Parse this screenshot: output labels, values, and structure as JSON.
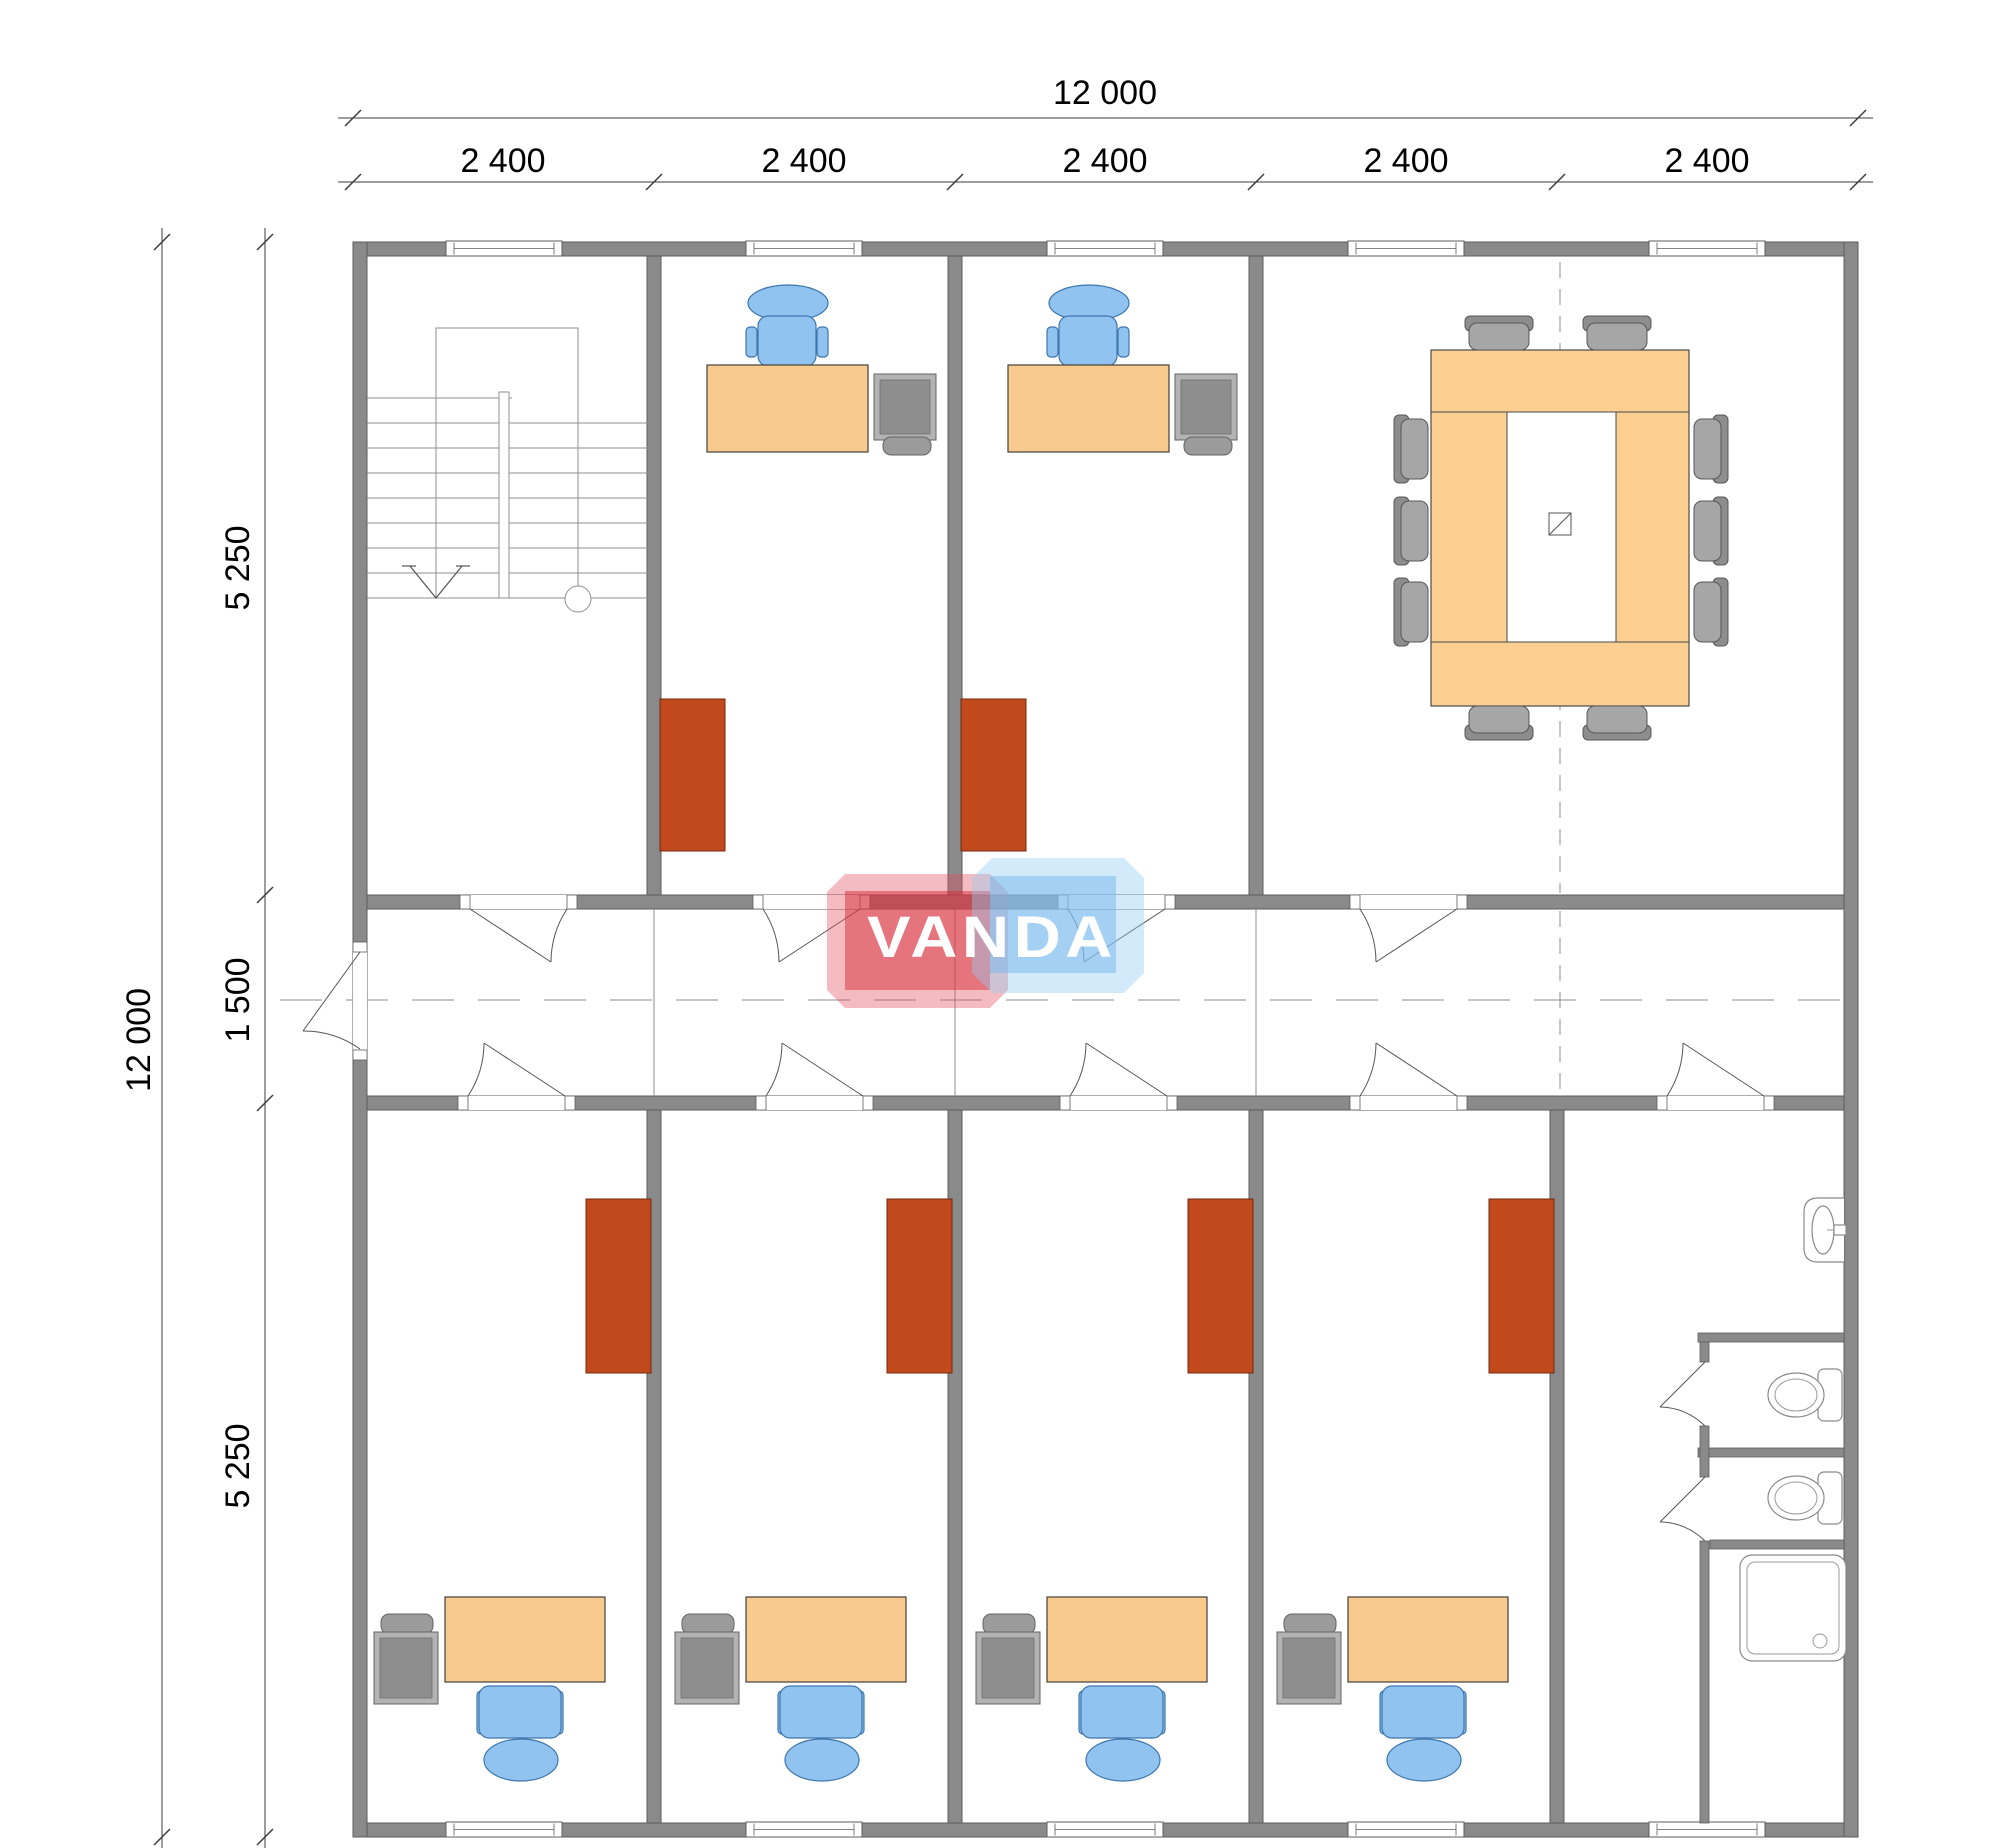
{
  "dimensions": {
    "top": {
      "total": "12 000",
      "segments": [
        "2 400",
        "2 400",
        "2 400",
        "2 400",
        "2 400"
      ]
    },
    "left": {
      "total": "12 000",
      "segments": [
        "5 250",
        "1 500",
        "5 250"
      ]
    }
  },
  "watermark": {
    "text": "VANDA",
    "red_color": "#d93a46",
    "blue_color": "#9fd0f0"
  },
  "palette": {
    "wall_gray": "#8a8a8a",
    "desk_tan": "#F8CA8E",
    "chair_blue": "#90C3EF",
    "cabinet_red": "#C2491C",
    "furniture_gray": "#9b9b9b"
  }
}
